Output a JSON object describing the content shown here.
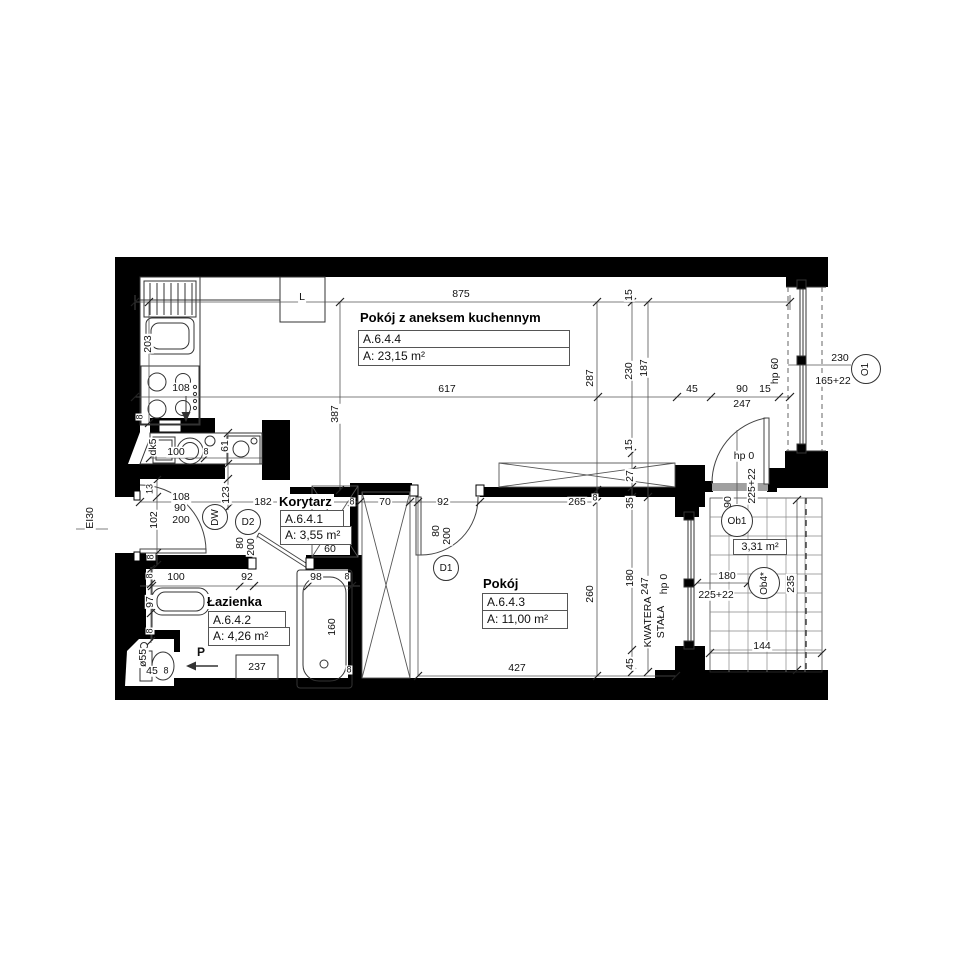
{
  "meta": {
    "drawing_type": "apartment floor plan",
    "background_color": "#ffffff",
    "wall_color": "#000000",
    "line_color": "#3c3c3c"
  },
  "rooms": {
    "living": {
      "title": "Pokój z aneksem kuchennym",
      "code": "A.6.4.4",
      "area": "A: 23,15 m²"
    },
    "hall": {
      "title": "Korytarz",
      "code": "A.6.4.1",
      "area": "A: 3,55 m²"
    },
    "room": {
      "title": "Pokój",
      "code": "A.6.4.3",
      "area": "A: 11,00 m²"
    },
    "bath": {
      "title": "Łazienka",
      "code": "A.6.4.2",
      "area": "A: 4,26 m²"
    },
    "balcony_area": "3,31 m²"
  },
  "markers": [
    {
      "name": "door-marker-dw",
      "t": "DW",
      "x": 215,
      "y": 517,
      "r": 13,
      "rot": true
    },
    {
      "name": "door-marker-d2",
      "t": "D2",
      "x": 248,
      "y": 522,
      "r": 13,
      "rot": false
    },
    {
      "name": "door-marker-d1",
      "t": "D1",
      "x": 446,
      "y": 568,
      "r": 13,
      "rot": false
    },
    {
      "name": "window-marker-o1",
      "t": "O1",
      "x": 866,
      "y": 369,
      "r": 15,
      "rot": true
    },
    {
      "name": "balcony-marker-ob1",
      "t": "Ob1",
      "x": 737,
      "y": 521,
      "r": 16,
      "rot": false
    },
    {
      "name": "balcony-marker-ob4",
      "t": "Ob4*",
      "x": 764,
      "y": 583,
      "r": 16,
      "rot": true
    }
  ],
  "dim_labels": [
    {
      "name": "dim-875",
      "t": "875",
      "x": 461,
      "y": 294
    },
    {
      "name": "dim-617",
      "t": "617",
      "x": 447,
      "y": 389
    },
    {
      "name": "dim-45-top",
      "t": "45",
      "x": 692,
      "y": 389
    },
    {
      "name": "dim-90-top",
      "t": "90",
      "x": 742,
      "y": 389
    },
    {
      "name": "dim-15-top",
      "t": "15",
      "x": 765,
      "y": 389
    },
    {
      "name": "dim-247-top",
      "t": "247",
      "x": 742,
      "y": 404
    },
    {
      "name": "dim-hp0-door",
      "t": "hp 0",
      "x": 744,
      "y": 456
    },
    {
      "name": "dim-230-o1",
      "t": "230",
      "x": 840,
      "y": 358
    },
    {
      "name": "dim-165-22-o1",
      "t": "165+22",
      "x": 833,
      "y": 381
    },
    {
      "name": "fridge-label",
      "t": "L",
      "x": 302,
      "y": 297
    },
    {
      "name": "dim-108-kitchen",
      "t": "108",
      "x": 181,
      "y": 388
    },
    {
      "name": "dim-100-alcove",
      "t": "100",
      "x": 176,
      "y": 452
    },
    {
      "name": "dim-8-alcove",
      "t": "8",
      "x": 206,
      "y": 452,
      "small": true
    },
    {
      "name": "dim-108-entry",
      "t": "108",
      "x": 181,
      "y": 497
    },
    {
      "name": "dim-90-entry",
      "t": "90",
      "x": 180,
      "y": 508
    },
    {
      "name": "dim-200-entry",
      "t": "200",
      "x": 181,
      "y": 520
    },
    {
      "name": "dim-182",
      "t": "182",
      "x": 263,
      "y": 502
    },
    {
      "name": "dim-8-hall",
      "t": "8",
      "x": 352,
      "y": 502,
      "small": true
    },
    {
      "name": "dim-70",
      "t": "70",
      "x": 385,
      "y": 502
    },
    {
      "name": "dim-92-d1",
      "t": "92",
      "x": 443,
      "y": 502
    },
    {
      "name": "dim-265",
      "t": "265",
      "x": 577,
      "y": 502
    },
    {
      "name": "dim-8-265",
      "t": "8",
      "x": 595,
      "y": 498,
      "small": true
    },
    {
      "name": "dim-60",
      "t": "60",
      "x": 330,
      "y": 549
    },
    {
      "name": "dim-427",
      "t": "427",
      "x": 517,
      "y": 668
    },
    {
      "name": "dim-100-bath",
      "t": "100",
      "x": 176,
      "y": 577
    },
    {
      "name": "dim-92-bath",
      "t": "92",
      "x": 247,
      "y": 577
    },
    {
      "name": "dim-98-bath",
      "t": "98",
      "x": 316,
      "y": 577
    },
    {
      "name": "dim-8-bath",
      "t": "8",
      "x": 347,
      "y": 577,
      "small": true
    },
    {
      "name": "dim-45-wc",
      "t": "45",
      "x": 152,
      "y": 671
    },
    {
      "name": "dim-8-wc",
      "t": "8",
      "x": 166,
      "y": 671,
      "small": true
    },
    {
      "name": "appliance-237",
      "t": "237",
      "x": 257,
      "y": 667
    },
    {
      "name": "entry-arrow-label",
      "t": "P",
      "x": 201,
      "y": 652,
      "bold": true
    },
    {
      "name": "dim-144",
      "t": "144",
      "x": 762,
      "y": 646
    },
    {
      "name": "dim-180-balc",
      "t": "180",
      "x": 727,
      "y": 576
    },
    {
      "name": "dim-225-22-balc-b",
      "t": "225+22",
      "x": 716,
      "y": 595
    },
    {
      "name": "dim-8-tub",
      "t": "8",
      "x": 349,
      "y": 670,
      "small": true
    },
    {
      "name": "dim-203",
      "t": "203",
      "x": 148,
      "y": 344,
      "rot": true
    },
    {
      "name": "dim-8-kitchen",
      "t": "8",
      "x": 140,
      "y": 417,
      "rot": true,
      "small": true
    },
    {
      "name": "dim-61",
      "t": "61",
      "x": 225,
      "y": 446,
      "rot": true
    },
    {
      "name": "dim-123",
      "t": "123",
      "x": 226,
      "y": 495,
      "rot": true
    },
    {
      "name": "shaft-label-dk5",
      "t": "dk5",
      "x": 153,
      "y": 447,
      "rot": true
    },
    {
      "name": "dim-387",
      "t": "387",
      "x": 335,
      "y": 414,
      "rot": true
    },
    {
      "name": "dim-287",
      "t": "287",
      "x": 590,
      "y": 378,
      "rot": true
    },
    {
      "name": "dim-230-right",
      "t": "230",
      "x": 629,
      "y": 371,
      "rot": true
    },
    {
      "name": "dim-187-right",
      "t": "187",
      "x": 644,
      "y": 368,
      "rot": true
    },
    {
      "name": "dim-15-topright",
      "t": "15",
      "x": 629,
      "y": 295,
      "rot": true
    },
    {
      "name": "dim-15-mid",
      "t": "15",
      "x": 629,
      "y": 445,
      "rot": true
    },
    {
      "name": "dim-27",
      "t": "27",
      "x": 630,
      "y": 476,
      "rot": true
    },
    {
      "name": "dim-35",
      "t": "35",
      "x": 630,
      "y": 503,
      "rot": true
    },
    {
      "name": "dim-180-right",
      "t": "180",
      "x": 630,
      "y": 578,
      "rot": true
    },
    {
      "name": "dim-45-botright",
      "t": "45",
      "x": 630,
      "y": 664,
      "rot": true
    },
    {
      "name": "dim-247-right",
      "t": "247",
      "x": 645,
      "y": 586,
      "rot": true
    },
    {
      "name": "dim-260",
      "t": "260",
      "x": 590,
      "y": 594,
      "rot": true
    },
    {
      "name": "dim-160",
      "t": "160",
      "x": 332,
      "y": 627,
      "rot": true
    },
    {
      "name": "dim-97",
      "t": "97",
      "x": 150,
      "y": 602,
      "rot": true
    },
    {
      "name": "dim-8-basin-top",
      "t": "8",
      "x": 150,
      "y": 576,
      "rot": true,
      "small": true
    },
    {
      "name": "dim-8-basin-bot",
      "t": "8",
      "x": 150,
      "y": 631,
      "rot": true,
      "small": true
    },
    {
      "name": "dim-o55",
      "t": "ø55",
      "x": 143,
      "y": 658,
      "rot": true
    },
    {
      "name": "dim-13",
      "t": "13",
      "x": 150,
      "y": 489,
      "rot": true,
      "small": true
    },
    {
      "name": "dim-102",
      "t": "102",
      "x": 154,
      "y": 520,
      "rot": true
    },
    {
      "name": "dim-8-entry",
      "t": "8",
      "x": 151,
      "y": 557,
      "rot": true,
      "small": true
    },
    {
      "name": "fire-rating-label",
      "t": "EI30",
      "x": 90,
      "y": 518,
      "rot": true
    },
    {
      "name": "dim-hp60",
      "t": "hp 60",
      "x": 775,
      "y": 371,
      "rot": true
    },
    {
      "name": "dim-hp0-fixed",
      "t": "hp 0",
      "x": 664,
      "y": 584,
      "rot": true
    },
    {
      "name": "dim-90-balc",
      "t": "90",
      "x": 728,
      "y": 502,
      "rot": true
    },
    {
      "name": "dim-225-22-balc-a",
      "t": "225+22",
      "x": 752,
      "y": 486,
      "rot": true
    },
    {
      "name": "dim-235",
      "t": "235",
      "x": 791,
      "y": 584,
      "rot": true
    },
    {
      "name": "fixed-glazing-label-1",
      "t": "KWATERA",
      "x": 648,
      "y": 622,
      "rot": true
    },
    {
      "name": "fixed-glazing-label-2",
      "t": "STAŁA",
      "x": 661,
      "y": 622,
      "rot": true
    },
    {
      "name": "dim-80-d1",
      "t": "80",
      "x": 436,
      "y": 531,
      "rot": true
    },
    {
      "name": "dim-200-d1",
      "t": "200",
      "x": 447,
      "y": 536,
      "rot": true
    },
    {
      "name": "dim-80-d2",
      "t": "80",
      "x": 240,
      "y": 543,
      "rot": true
    },
    {
      "name": "dim-200-d2",
      "t": "200",
      "x": 251,
      "y": 547,
      "rot": true
    }
  ]
}
